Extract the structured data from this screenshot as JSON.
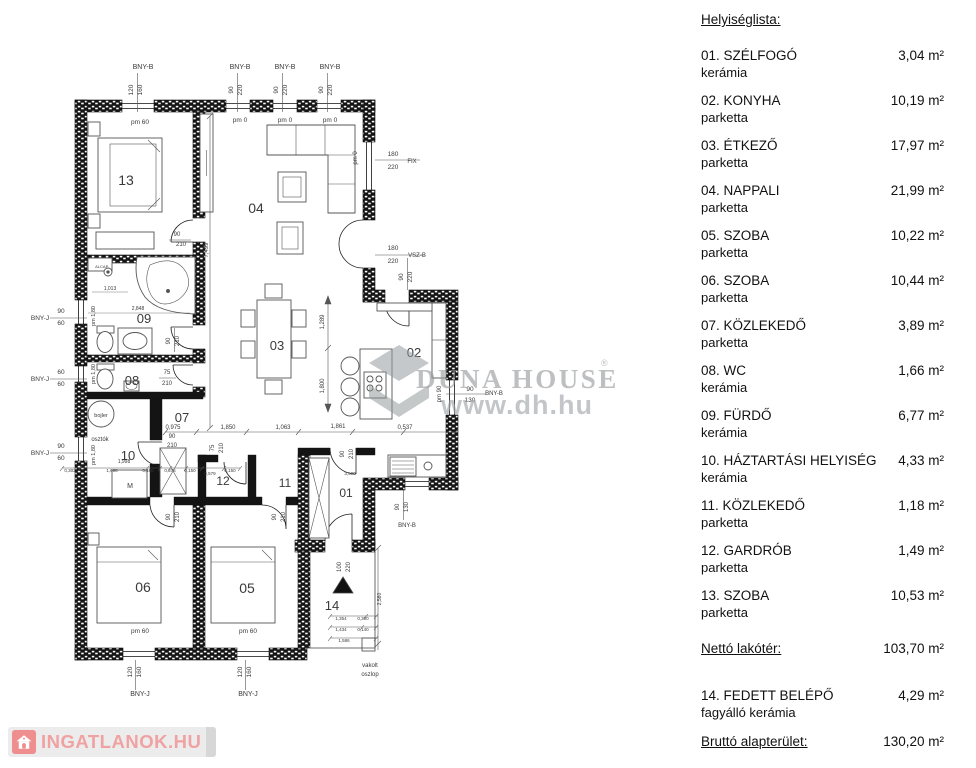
{
  "room_list": {
    "title": "Helyiséglista:",
    "items": [
      {
        "name": "01. SZÉLFOGÓ",
        "material": "kerámia",
        "area": "3,04 m²"
      },
      {
        "name": "02. KONYHA",
        "material": "parketta",
        "area": "10,19 m²"
      },
      {
        "name": "03. ÉTKEZŐ",
        "material": "parketta",
        "area": "17,97 m²"
      },
      {
        "name": "04. NAPPALI",
        "material": "parketta",
        "area": "21,99 m²"
      },
      {
        "name": "05. SZOBA",
        "material": "parketta",
        "area": "10,22 m²"
      },
      {
        "name": "06. SZOBA",
        "material": "parketta",
        "area": "10,44 m²"
      },
      {
        "name": "07. KÖZLEKEDŐ",
        "material": "parketta",
        "area": "3,89 m²"
      },
      {
        "name": "08. WC",
        "material": "kerámia",
        "area": "1,66 m²"
      },
      {
        "name": "09. FÜRDŐ",
        "material": "kerámia",
        "area": "6,77 m²"
      },
      {
        "name": "10. HÁZTARTÁSI HELYISÉG",
        "material": "kerámia",
        "area": "4,33 m²"
      },
      {
        "name": "11. KÖZLEKEDŐ",
        "material": "parketta",
        "area": "1,18 m²"
      },
      {
        "name": "12. GARDRÓB",
        "material": "parketta",
        "area": "1,49 m²"
      },
      {
        "name": "13. SZOBA",
        "material": "parketta",
        "area": "10,53 m²"
      }
    ],
    "net": {
      "label": "Nettó lakótér:",
      "area": "103,70 m²"
    },
    "extra": {
      "name": "14. FEDETT BELÉPŐ",
      "material": "fagyálló kerámia",
      "area": "4,29 m²"
    },
    "gross": {
      "label": "Bruttó alapterület:",
      "area": "130,20 m²"
    }
  },
  "watermark": {
    "brand": "DUNA HOUSE",
    "reg": "®",
    "url": "www.dh.hu"
  },
  "logo": {
    "text": "INGATLANOK.HU"
  },
  "floorplan": {
    "labels": [
      {
        "t": "BNY-B",
        "x": 143,
        "y": 69,
        "s": 7
      },
      {
        "t": "120",
        "x": 133,
        "y": 90,
        "r": -90
      },
      {
        "t": "160",
        "x": 142,
        "y": 90,
        "r": -90
      },
      {
        "t": "pm 60",
        "x": 140,
        "y": 124
      },
      {
        "t": "BNY-B",
        "x": 240,
        "y": 69,
        "s": 7
      },
      {
        "t": "90",
        "x": 233,
        "y": 90,
        "r": -90
      },
      {
        "t": "220",
        "x": 242,
        "y": 90,
        "r": -90
      },
      {
        "t": "pm 0",
        "x": 240,
        "y": 122
      },
      {
        "t": "BNY-B",
        "x": 285,
        "y": 69,
        "s": 7
      },
      {
        "t": "90",
        "x": 278,
        "y": 90,
        "r": -90
      },
      {
        "t": "220",
        "x": 287,
        "y": 90,
        "r": -90
      },
      {
        "t": "pm 0",
        "x": 285,
        "y": 122
      },
      {
        "t": "BNY-B",
        "x": 330,
        "y": 69,
        "s": 7
      },
      {
        "t": "90",
        "x": 323,
        "y": 90,
        "r": -90
      },
      {
        "t": "220",
        "x": 332,
        "y": 90,
        "r": -90
      },
      {
        "t": "pm 0",
        "x": 330,
        "y": 122
      },
      {
        "t": "pm 0",
        "x": 357,
        "y": 158,
        "r": -90,
        "s": 6
      },
      {
        "t": "180",
        "x": 393,
        "y": 156
      },
      {
        "t": "220",
        "x": 393,
        "y": 169
      },
      {
        "t": "FIX",
        "x": 412,
        "y": 163,
        "s": 6
      },
      {
        "t": "180",
        "x": 393,
        "y": 250
      },
      {
        "t": "220",
        "x": 393,
        "y": 263
      },
      {
        "t": "VSZ-B",
        "x": 417,
        "y": 257,
        "s": 6
      },
      {
        "t": "90",
        "x": 403,
        "y": 277,
        "r": -90
      },
      {
        "t": "220",
        "x": 412,
        "y": 277,
        "r": -90
      },
      {
        "t": "90",
        "x": 470,
        "y": 391
      },
      {
        "t": "130",
        "x": 470,
        "y": 402
      },
      {
        "t": "BNY-B",
        "x": 494,
        "y": 395,
        "s": 6
      },
      {
        "t": "pm 90",
        "x": 441,
        "y": 394,
        "r": -90,
        "s": 6
      },
      {
        "t": "BNY-J",
        "x": 40,
        "y": 320,
        "s": 6.5
      },
      {
        "t": "90",
        "x": 61,
        "y": 313
      },
      {
        "t": "60",
        "x": 61,
        "y": 325
      },
      {
        "t": "BNY-J",
        "x": 40,
        "y": 381,
        "s": 6.5
      },
      {
        "t": "60",
        "x": 61,
        "y": 374
      },
      {
        "t": "60",
        "x": 61,
        "y": 386
      },
      {
        "t": "BNY-J",
        "x": 40,
        "y": 455,
        "s": 6.5
      },
      {
        "t": "90",
        "x": 61,
        "y": 448
      },
      {
        "t": "60",
        "x": 61,
        "y": 460
      },
      {
        "t": "pm 1,80",
        "x": 95,
        "y": 316,
        "r": -90,
        "s": 5.5
      },
      {
        "t": "pm 1,80",
        "x": 95,
        "y": 374,
        "r": -90,
        "s": 5.5
      },
      {
        "t": "pm 1,80",
        "x": 95,
        "y": 455,
        "r": -90,
        "s": 5.5
      },
      {
        "t": "osztók",
        "x": 100,
        "y": 441,
        "s": 6
      },
      {
        "t": "pm 60",
        "x": 140,
        "y": 633
      },
      {
        "t": "120",
        "x": 132,
        "y": 672,
        "r": -90
      },
      {
        "t": "160",
        "x": 141,
        "y": 672,
        "r": -90
      },
      {
        "t": "BNY-J",
        "x": 140,
        "y": 696,
        "s": 7
      },
      {
        "t": "pm 60",
        "x": 248,
        "y": 633
      },
      {
        "t": "120",
        "x": 242,
        "y": 672,
        "r": -90
      },
      {
        "t": "160",
        "x": 251,
        "y": 672,
        "r": -90
      },
      {
        "t": "BNY-J",
        "x": 248,
        "y": 696,
        "s": 7
      },
      {
        "t": "vakolt",
        "x": 370,
        "y": 667,
        "s": 6
      },
      {
        "t": "oszlop",
        "x": 370,
        "y": 676,
        "s": 6
      },
      {
        "t": "13",
        "x": 126,
        "y": 185,
        "s": 14,
        "c": "#1a1a1a"
      },
      {
        "t": "04",
        "x": 256,
        "y": 213,
        "s": 14,
        "c": "#1a1a1a"
      },
      {
        "t": "09",
        "x": 144,
        "y": 323,
        "s": 13,
        "c": "#1a1a1a"
      },
      {
        "t": "03",
        "x": 277,
        "y": 350,
        "s": 13,
        "c": "#1a1a1a"
      },
      {
        "t": "02",
        "x": 414,
        "y": 357,
        "s": 13,
        "c": "#1a1a1a"
      },
      {
        "t": "08",
        "x": 132,
        "y": 385,
        "s": 13,
        "c": "#1a1a1a"
      },
      {
        "t": "07",
        "x": 182,
        "y": 422,
        "s": 13,
        "c": "#1a1a1a"
      },
      {
        "t": "10",
        "x": 128,
        "y": 460,
        "s": 13,
        "c": "#1a1a1a"
      },
      {
        "t": "12",
        "x": 223,
        "y": 485,
        "s": 12,
        "c": "#1a1a1a"
      },
      {
        "t": "11",
        "x": 285,
        "y": 487,
        "s": 12,
        "c": "#1a1a1a"
      },
      {
        "t": "01",
        "x": 346,
        "y": 497,
        "s": 12,
        "c": "#1a1a1a"
      },
      {
        "t": "06",
        "x": 143,
        "y": 592,
        "s": 14,
        "c": "#1a1a1a"
      },
      {
        "t": "05",
        "x": 247,
        "y": 593,
        "s": 14,
        "c": "#1a1a1a"
      },
      {
        "t": "14",
        "x": 332,
        "y": 610,
        "s": 13,
        "c": "#1a1a1a"
      },
      {
        "t": "0,975",
        "x": 173,
        "y": 429,
        "s": 6
      },
      {
        "t": "90",
        "x": 172,
        "y": 438,
        "s": 6
      },
      {
        "t": "210",
        "x": 172,
        "y": 447,
        "s": 6
      },
      {
        "t": "1,850",
        "x": 228,
        "y": 429,
        "s": 6
      },
      {
        "t": "1,063",
        "x": 283,
        "y": 429,
        "s": 6
      },
      {
        "t": "1,861",
        "x": 338,
        "y": 428,
        "s": 6
      },
      {
        "t": "0,537",
        "x": 405,
        "y": 429,
        "s": 6
      },
      {
        "t": "7,499",
        "x": 208,
        "y": 250,
        "r": -90,
        "s": 6
      },
      {
        "t": "1,289",
        "x": 324,
        "y": 322,
        "r": -90,
        "s": 6
      },
      {
        "t": "1,800",
        "x": 324,
        "y": 386,
        "r": -90,
        "s": 6
      },
      {
        "t": "90",
        "x": 177,
        "y": 236,
        "s": 6
      },
      {
        "t": "210",
        "x": 181,
        "y": 246,
        "s": 6
      },
      {
        "t": "90",
        "x": 170,
        "y": 341,
        "r": -90,
        "s": 6
      },
      {
        "t": "210",
        "x": 179,
        "y": 341,
        "r": -90,
        "s": 6
      },
      {
        "t": "75",
        "x": 167,
        "y": 374,
        "s": 6
      },
      {
        "t": "210",
        "x": 167,
        "y": 385,
        "s": 6
      },
      {
        "t": "2,848",
        "x": 138,
        "y": 310,
        "s": 5
      },
      {
        "t": "1,013",
        "x": 110,
        "y": 290,
        "s": 5
      },
      {
        "t": "75",
        "x": 214,
        "y": 448,
        "r": -90,
        "s": 6
      },
      {
        "t": "210",
        "x": 223,
        "y": 448,
        "r": -90,
        "s": 6
      },
      {
        "t": "90",
        "x": 170,
        "y": 517,
        "r": -90,
        "s": 6
      },
      {
        "t": "210",
        "x": 179,
        "y": 517,
        "r": -90,
        "s": 6
      },
      {
        "t": "90",
        "x": 276,
        "y": 517,
        "r": -90,
        "s": 6
      },
      {
        "t": "210",
        "x": 285,
        "y": 517,
        "r": -90,
        "s": 6
      },
      {
        "t": "90",
        "x": 344,
        "y": 454,
        "r": -90,
        "s": 6
      },
      {
        "t": "210",
        "x": 353,
        "y": 454,
        "r": -90,
        "s": 6
      },
      {
        "t": "100",
        "x": 341,
        "y": 567,
        "r": -90,
        "s": 6
      },
      {
        "t": "220",
        "x": 350,
        "y": 567,
        "r": -90,
        "s": 6
      },
      {
        "t": "90",
        "x": 399,
        "y": 507,
        "r": -90,
        "s": 6
      },
      {
        "t": "130",
        "x": 408,
        "y": 507,
        "r": -90,
        "s": 6
      },
      {
        "t": "BNY-B",
        "x": 407,
        "y": 527,
        "s": 6
      },
      {
        "t": "1,998",
        "x": 124,
        "y": 463,
        "s": 5
      },
      {
        "t": "0,302",
        "x": 70,
        "y": 472,
        "s": 4.5
      },
      {
        "t": "1,698",
        "x": 112,
        "y": 472,
        "s": 4.5
      },
      {
        "t": "0,460",
        "x": 148,
        "y": 472,
        "s": 4.5
      },
      {
        "t": "0,375",
        "x": 170,
        "y": 472,
        "s": 4.5
      },
      {
        "t": "0,150",
        "x": 190,
        "y": 472,
        "s": 4.5
      },
      {
        "t": "0,579",
        "x": 210,
        "y": 475,
        "s": 4.5
      },
      {
        "t": "0,150",
        "x": 230,
        "y": 472,
        "s": 4.5
      },
      {
        "t": "3,500",
        "x": 350,
        "y": 475,
        "s": 4.5
      },
      {
        "t": "1,354",
        "x": 341,
        "y": 620,
        "s": 4.5
      },
      {
        "t": "0,300",
        "x": 363,
        "y": 620,
        "s": 4.5
      },
      {
        "t": "1,434",
        "x": 341,
        "y": 631,
        "s": 4.5
      },
      {
        "t": "0,140",
        "x": 363,
        "y": 631,
        "s": 4.5
      },
      {
        "t": "1,586",
        "x": 344,
        "y": 642,
        "s": 4.5
      },
      {
        "t": "2,580",
        "x": 381,
        "y": 599,
        "r": -90,
        "s": 5
      },
      {
        "t": "M",
        "x": 130,
        "y": 488,
        "s": 7
      },
      {
        "t": "bojler",
        "x": 101,
        "y": 417,
        "s": 5.5
      },
      {
        "t": "ALCAP.",
        "x": 102,
        "y": 268,
        "s": 4
      }
    ]
  }
}
